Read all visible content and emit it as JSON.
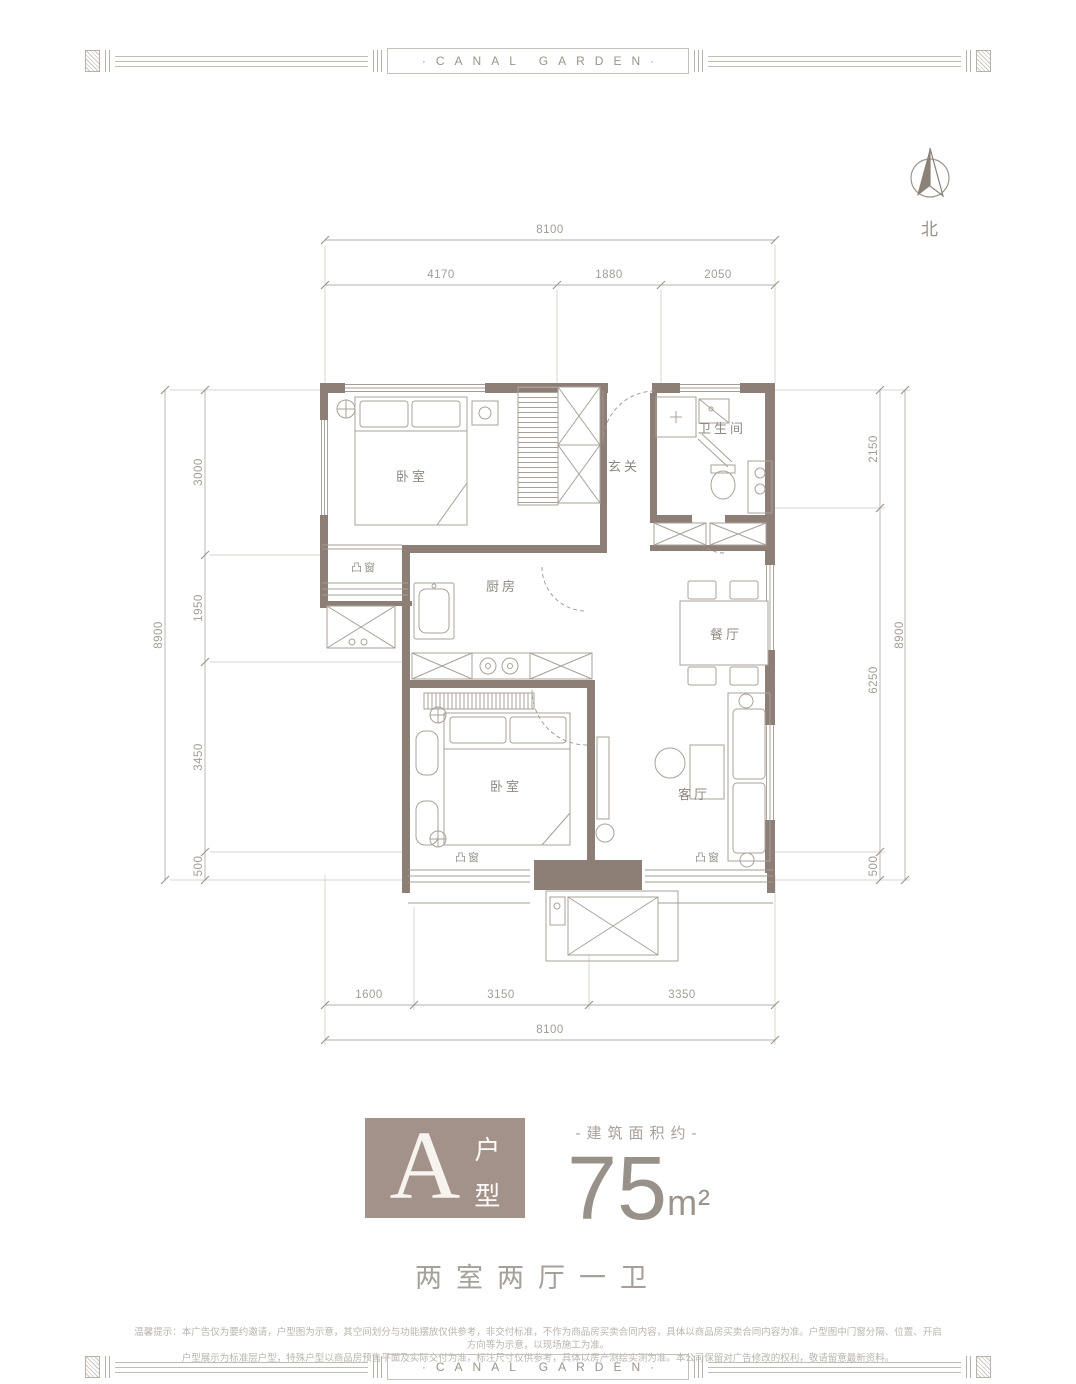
{
  "banner": {
    "title": "·CANAL GARDEN·"
  },
  "compass": {
    "north_label": "北"
  },
  "plan": {
    "rooms": {
      "bedroom1": "卧室",
      "entry": "玄关",
      "bathroom": "卫生间",
      "kitchen": "厨房",
      "dining": "餐厅",
      "bedroom2": "卧室",
      "living": "客厅",
      "bay_window": "凸窗"
    },
    "dims": {
      "top_total": "8100",
      "top": [
        "4170",
        "1880",
        "2050"
      ],
      "left_total": "8900",
      "left": [
        "3000",
        "1950",
        "3450",
        "500"
      ],
      "right": [
        "2150",
        "6250",
        "500"
      ],
      "right_total": "8900",
      "bottom": [
        "1600",
        "3150",
        "3350"
      ],
      "bottom_total": "8100"
    }
  },
  "unit": {
    "letter": "A",
    "type_char1": "户",
    "type_char2": "型",
    "area_label": "-建筑面积约-",
    "area_value": "75",
    "area_unit": "m²",
    "layout": "两室两厅一卫"
  },
  "disclaimer": {
    "line1": "温馨提示：本广告仅为要约邀请，户型图为示意，其空间划分与功能摆放仅供参考，非交付标准，不作为商品房买卖合同内容，具体以商品房买卖合同内容为准。户型图中门窗分隔、位置、开启方向等为示意，以现场施工为准。",
    "line2": "户型展示为标准层户型，特殊户型以商品房预售平面及实际交付为准，标注尺寸仅供参考，具体以房产测绘实测为准。本公司保留对广告修改的权利，敬请留意最新资料。"
  },
  "colors": {
    "wall": "#8d7f75",
    "badge": "#a2928a",
    "furniture_line": "#a9a199",
    "dim_text": "#a49c94"
  }
}
